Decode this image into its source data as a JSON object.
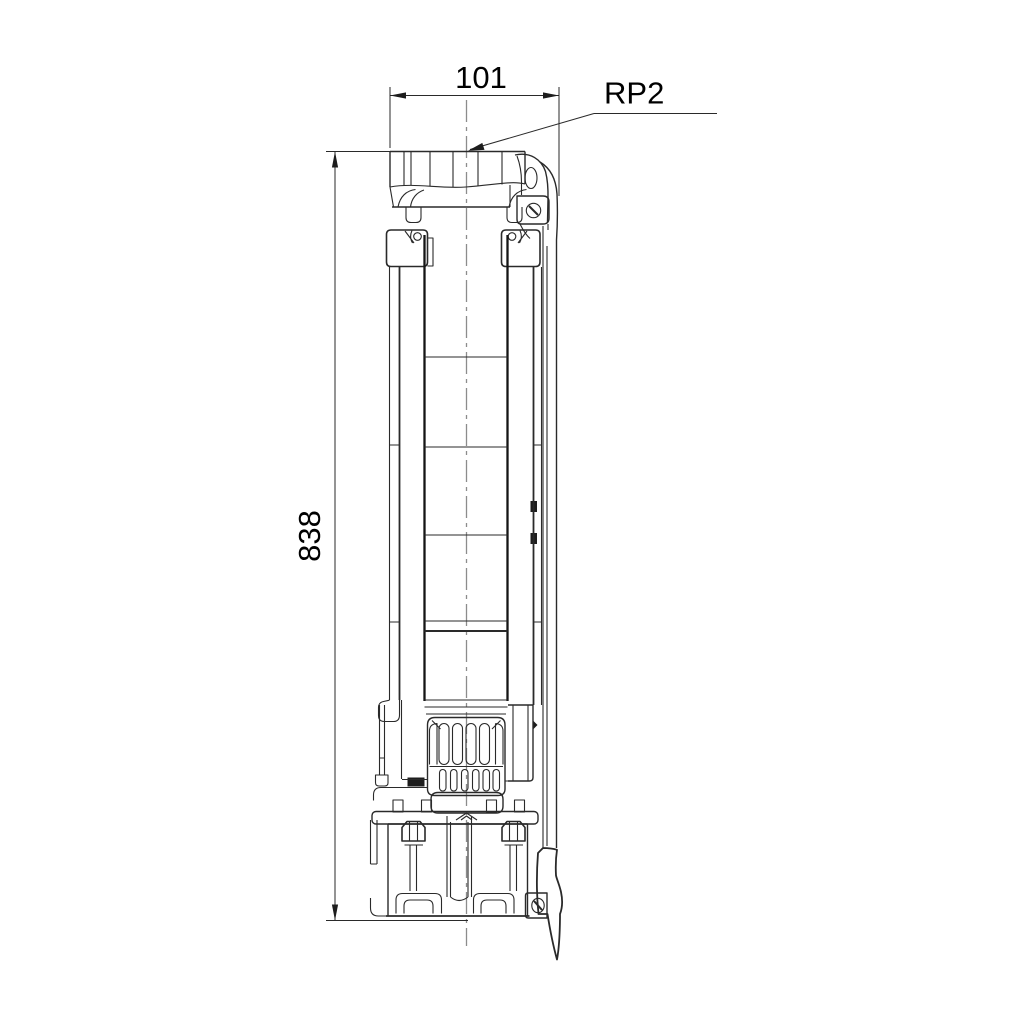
{
  "drawing": {
    "type": "technical-dimension-drawing",
    "subject": "submersible-pump-side-elevation",
    "dim_width_label": "101",
    "dim_height_label": "838",
    "connection_label": "RP2",
    "colors": {
      "line": "#2a2a2a",
      "thick_line": "#151515",
      "centerline": "#8c8c8c",
      "text": "#000000",
      "background": "#ffffff"
    }
  }
}
